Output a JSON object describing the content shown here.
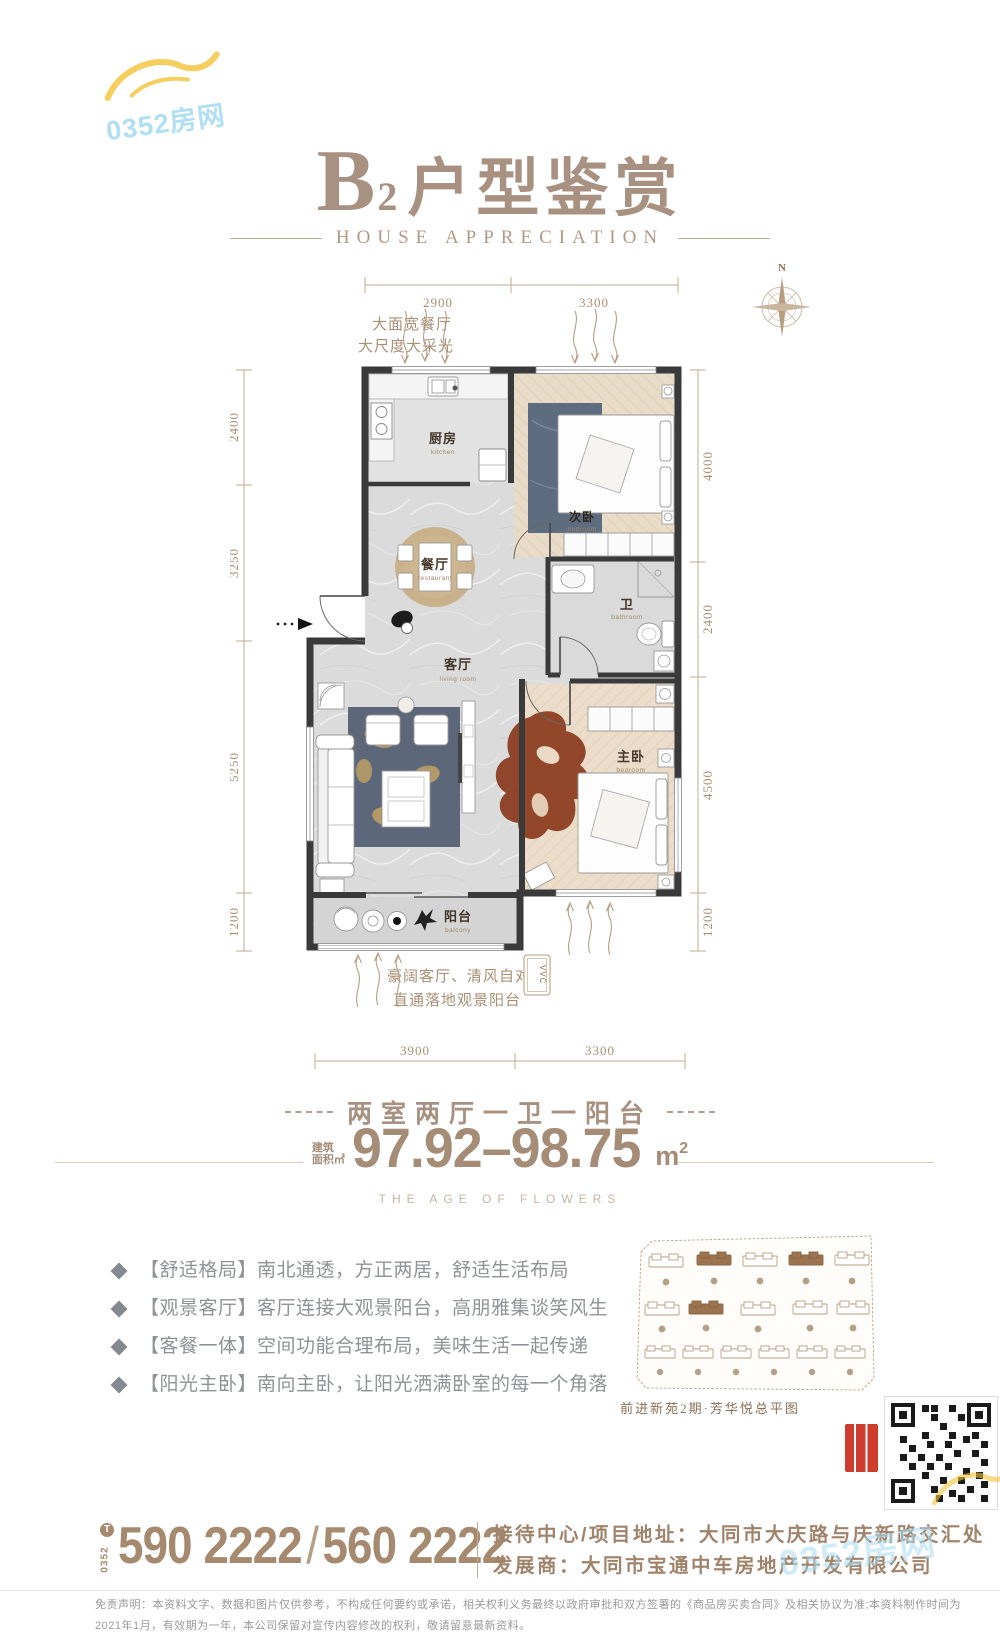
{
  "watermark": {
    "text": "0352房网"
  },
  "header": {
    "title_letter": "B",
    "title_sub": "2",
    "title_cn": "户型鉴赏",
    "subtitle": "HOUSE APPRECIATION"
  },
  "floorplan": {
    "compass_label": "N",
    "note_top_line1": "大面宽餐厅",
    "note_top_line2": "大尺度大采光",
    "note_bottom_line1": "豪阔客厅、清风自对流",
    "note_bottom_line2": "直通落地观景阳台",
    "dims_top": [
      "2900",
      "3300"
    ],
    "dims_left": [
      "2400",
      "3250",
      "5250",
      "1200"
    ],
    "dims_right": [
      "4000",
      "2400",
      "4500",
      "1200"
    ],
    "dims_bottom": [
      "3900",
      "3300"
    ],
    "rooms": {
      "kitchen": {
        "cn": "厨房",
        "en": "kitchen"
      },
      "dining": {
        "cn": "餐厅",
        "en": "restaurant"
      },
      "bedroom2": {
        "cn": "次卧",
        "en": "bedroom"
      },
      "bath": {
        "cn": "卫",
        "en": "bathroom"
      },
      "living": {
        "cn": "客厅",
        "en": "living room"
      },
      "master": {
        "cn": "主卧",
        "en": "bedroom"
      },
      "balcony": {
        "cn": "阳台",
        "en": "balcony"
      }
    },
    "ac_label": "VVC"
  },
  "summary": {
    "layout_line": "两室两厅一卫一阳台",
    "area_label_line1": "建筑",
    "area_label_line2": "面积㎡",
    "area_value": "97.92–98.75",
    "area_unit": "m",
    "area_sup": "2",
    "tagline": "THE AGE OF FLOWERS"
  },
  "features": [
    "【舒适格局】南北通透，方正两居，舒适生活布局",
    "【观景客厅】客厅连接大观景阳台，高朋雅集谈笑风生",
    "【客餐一体】空间功能合理布局，美味生活一起传递",
    "【阳光主卧】南向主卧，让阳光洒满卧室的每一个角落"
  ],
  "siteplan": {
    "caption": "前进新苑2期·芳华悦总平图"
  },
  "footer": {
    "phone_icon_letter": "T",
    "phone_prefix": "0352",
    "phone1": "590 2222",
    "phone_separator": "/",
    "phone2": "560 2222",
    "address_label": "接待中心/项目地址：",
    "address_value": "大同市大庆路与庆新路交汇处",
    "developer_label": "发展商：",
    "developer_value": "大同市宝通中车房地产开发有限公司",
    "disclaimer_line1": "免责声明：本资料文字、数据和图片仅供参考，不构成任何要约或承诺，相关权利义务最终以政府审批和双方签署的《商品房买卖合同》及相关协议为准;本资料制作时间为",
    "disclaimer_line2": "2021年1月，有效期为一年，本公司保留对宣传内容修改的权利，敬请留意最新资料。"
  },
  "colors": {
    "accent": "#a89180",
    "dim_text": "#a98f74",
    "wall": "#3a3a3a",
    "feature_text": "#8f9296",
    "watermark_blue": "#a8dcf2",
    "watermark_yellow": "#f4c338",
    "highlight_brown": "#9c7350",
    "seal_red": "#cf3b2f"
  }
}
